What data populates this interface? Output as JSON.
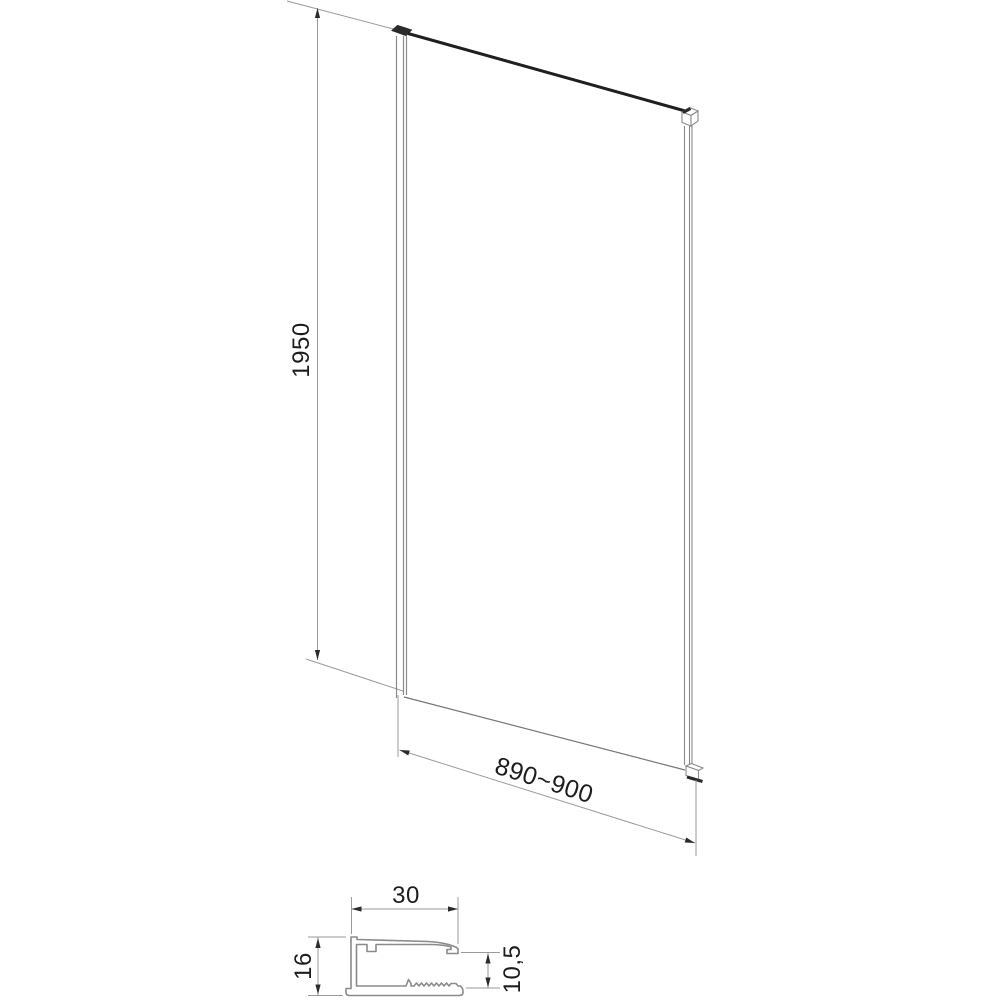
{
  "main_view": {
    "height_dimension": {
      "value": "1950"
    },
    "width_dimension": {
      "value": "890~900"
    }
  },
  "profile_section": {
    "width_dimension": {
      "value": "30"
    },
    "height_dimension": {
      "value": "16"
    },
    "glass_slot_dimension": {
      "value": "10,5"
    }
  },
  "colors": {
    "thin_line": "#9a9a9a",
    "outline": "#8a8a8a",
    "dark_line": "#1f1f1f",
    "arrow": "#2b2b2b",
    "text": "#1d1d1d",
    "background": "#ffffff"
  }
}
